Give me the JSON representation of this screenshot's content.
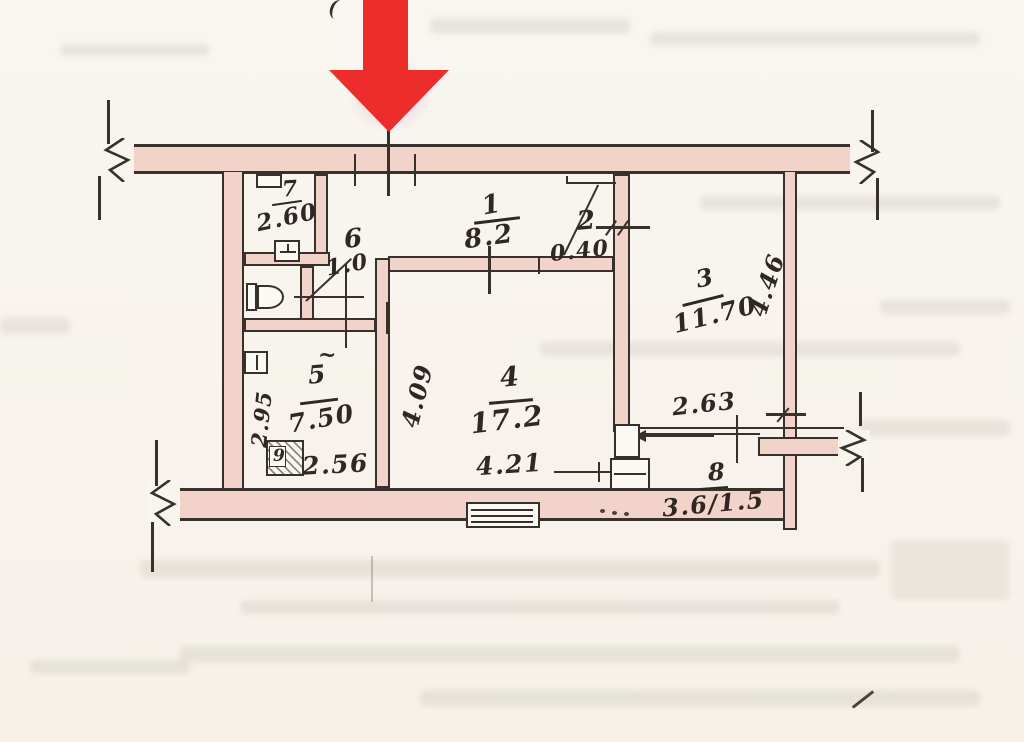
{
  "plan": {
    "pointer_color": "#ed2c2c",
    "wall_fill": "#f1d3c9",
    "ink_color": "#38302b",
    "rooms": [
      {
        "number": "1",
        "area": "8.2"
      },
      {
        "number": "2",
        "area": "0.40"
      },
      {
        "number": "3",
        "area": "11.70"
      },
      {
        "number": "4",
        "area": "17.2"
      },
      {
        "number": "5",
        "area": "7.50"
      },
      {
        "number": "6",
        "area": "1.0"
      },
      {
        "number": "7",
        "area": "2.60"
      },
      {
        "number": "8",
        "area": "3.6/1.5"
      },
      {
        "number": "9",
        "area": ""
      }
    ],
    "dimensions": {
      "room3_depth": "4.46",
      "room4_depth": "4.09",
      "room4_width": "4.21",
      "room5_depth": "2.95",
      "room5_width": "2.56",
      "balcony_width": "2.63"
    },
    "marks": {
      "room5_tilde": "~"
    }
  },
  "icons": {
    "pointer": "red-down-arrow"
  }
}
